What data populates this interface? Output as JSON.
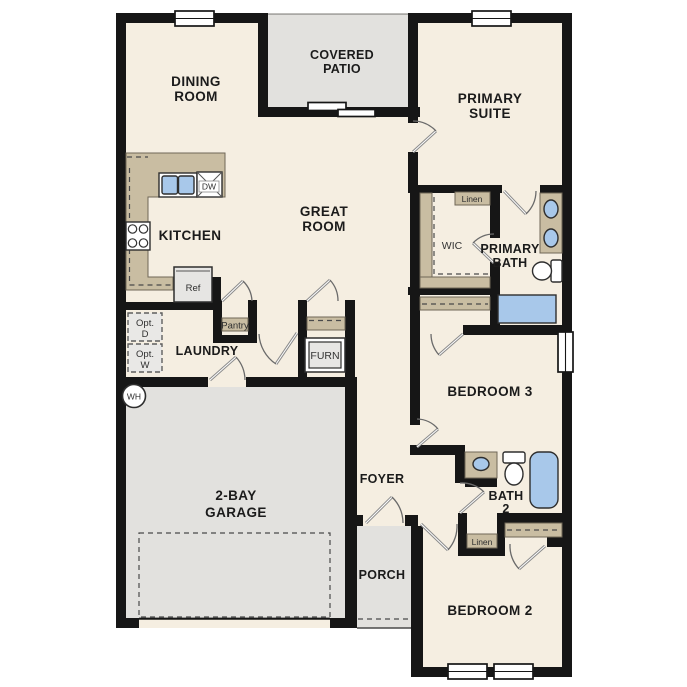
{
  "colors": {
    "page": "#ffffff",
    "floor": "#f5eee1",
    "outdoor": "#e2e1de",
    "wall": "#161616",
    "counter": "#c9bda2",
    "water": "#a8c8ea",
    "appliance": "#e6e5e3",
    "text": "#1b1b1b"
  },
  "rooms": {
    "dining": {
      "line1": "DINING",
      "line2": "ROOM"
    },
    "covered_patio": {
      "line1": "COVERED",
      "line2": "PATIO"
    },
    "primary_suite": {
      "line1": "PRIMARY",
      "line2": "SUITE"
    },
    "great_room": {
      "line1": "GREAT",
      "line2": "ROOM"
    },
    "kitchen": {
      "label": "KITCHEN"
    },
    "laundry": {
      "label": "LAUNDRY"
    },
    "wic": {
      "label": "WIC"
    },
    "primary_bath": {
      "line1": "PRIMARY",
      "line2": "BATH"
    },
    "bedroom3": {
      "label": "BEDROOM 3"
    },
    "bath2": {
      "line1": "BATH",
      "line2": "2"
    },
    "garage": {
      "line1": "2-BAY",
      "line2": "GARAGE"
    },
    "foyer": {
      "label": "FOYER"
    },
    "porch": {
      "label": "PORCH"
    },
    "bedroom2": {
      "label": "BEDROOM 2"
    }
  },
  "fixtures": {
    "dishwasher": "DW",
    "refrigerator": "Ref",
    "pantry": "Pantry",
    "furnace": "FURN",
    "water_heater": "WH",
    "opt_dryer": {
      "line1": "Opt.",
      "line2": "D"
    },
    "opt_washer": {
      "line1": "Opt.",
      "line2": "W"
    },
    "linen_primary": "Linen",
    "linen_hall": "Linen"
  }
}
